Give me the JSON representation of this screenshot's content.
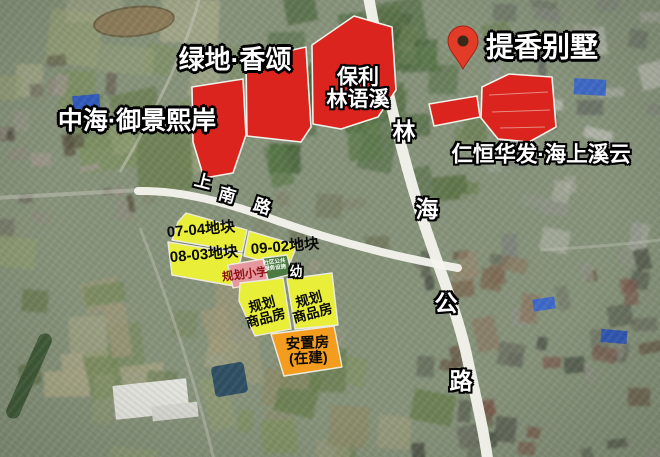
{
  "map": {
    "labels": {
      "greenland": "绿地·香颂",
      "tixiang_villa": "提香别墅",
      "zhonghai": "中海·御景熙岸",
      "baoli_line1": "保利",
      "baoli_line2": "林语溪",
      "renheng": "仁恒华发·海上溪云",
      "linhai_road": [
        "林",
        "海",
        "公",
        "路"
      ],
      "shangnan_road": [
        "上",
        "南",
        "路"
      ],
      "plot_0704": "07-04地块",
      "plot_0902": "09-02地块",
      "plot_0803": "08-03地块",
      "planned_school": "规划小学",
      "community_service_line1": "社区公共",
      "community_service_line2": "服务设施",
      "kindergarten": "幼",
      "commodity_line1": "规划",
      "commodity_line2": "商品房",
      "resettlement_line1": "安置房",
      "resettlement_line2": "(在建)"
    },
    "colors": {
      "development_red": "#da241d",
      "plot_yellow": "#e9ee38",
      "school_pink": "#e5989e",
      "service_green": "#4b7b43",
      "resettlement_orange": "#f49c1d",
      "road_white": "#f4f4ee",
      "pin_red": "#e23b28",
      "pin_hole": "#3a2818"
    }
  }
}
